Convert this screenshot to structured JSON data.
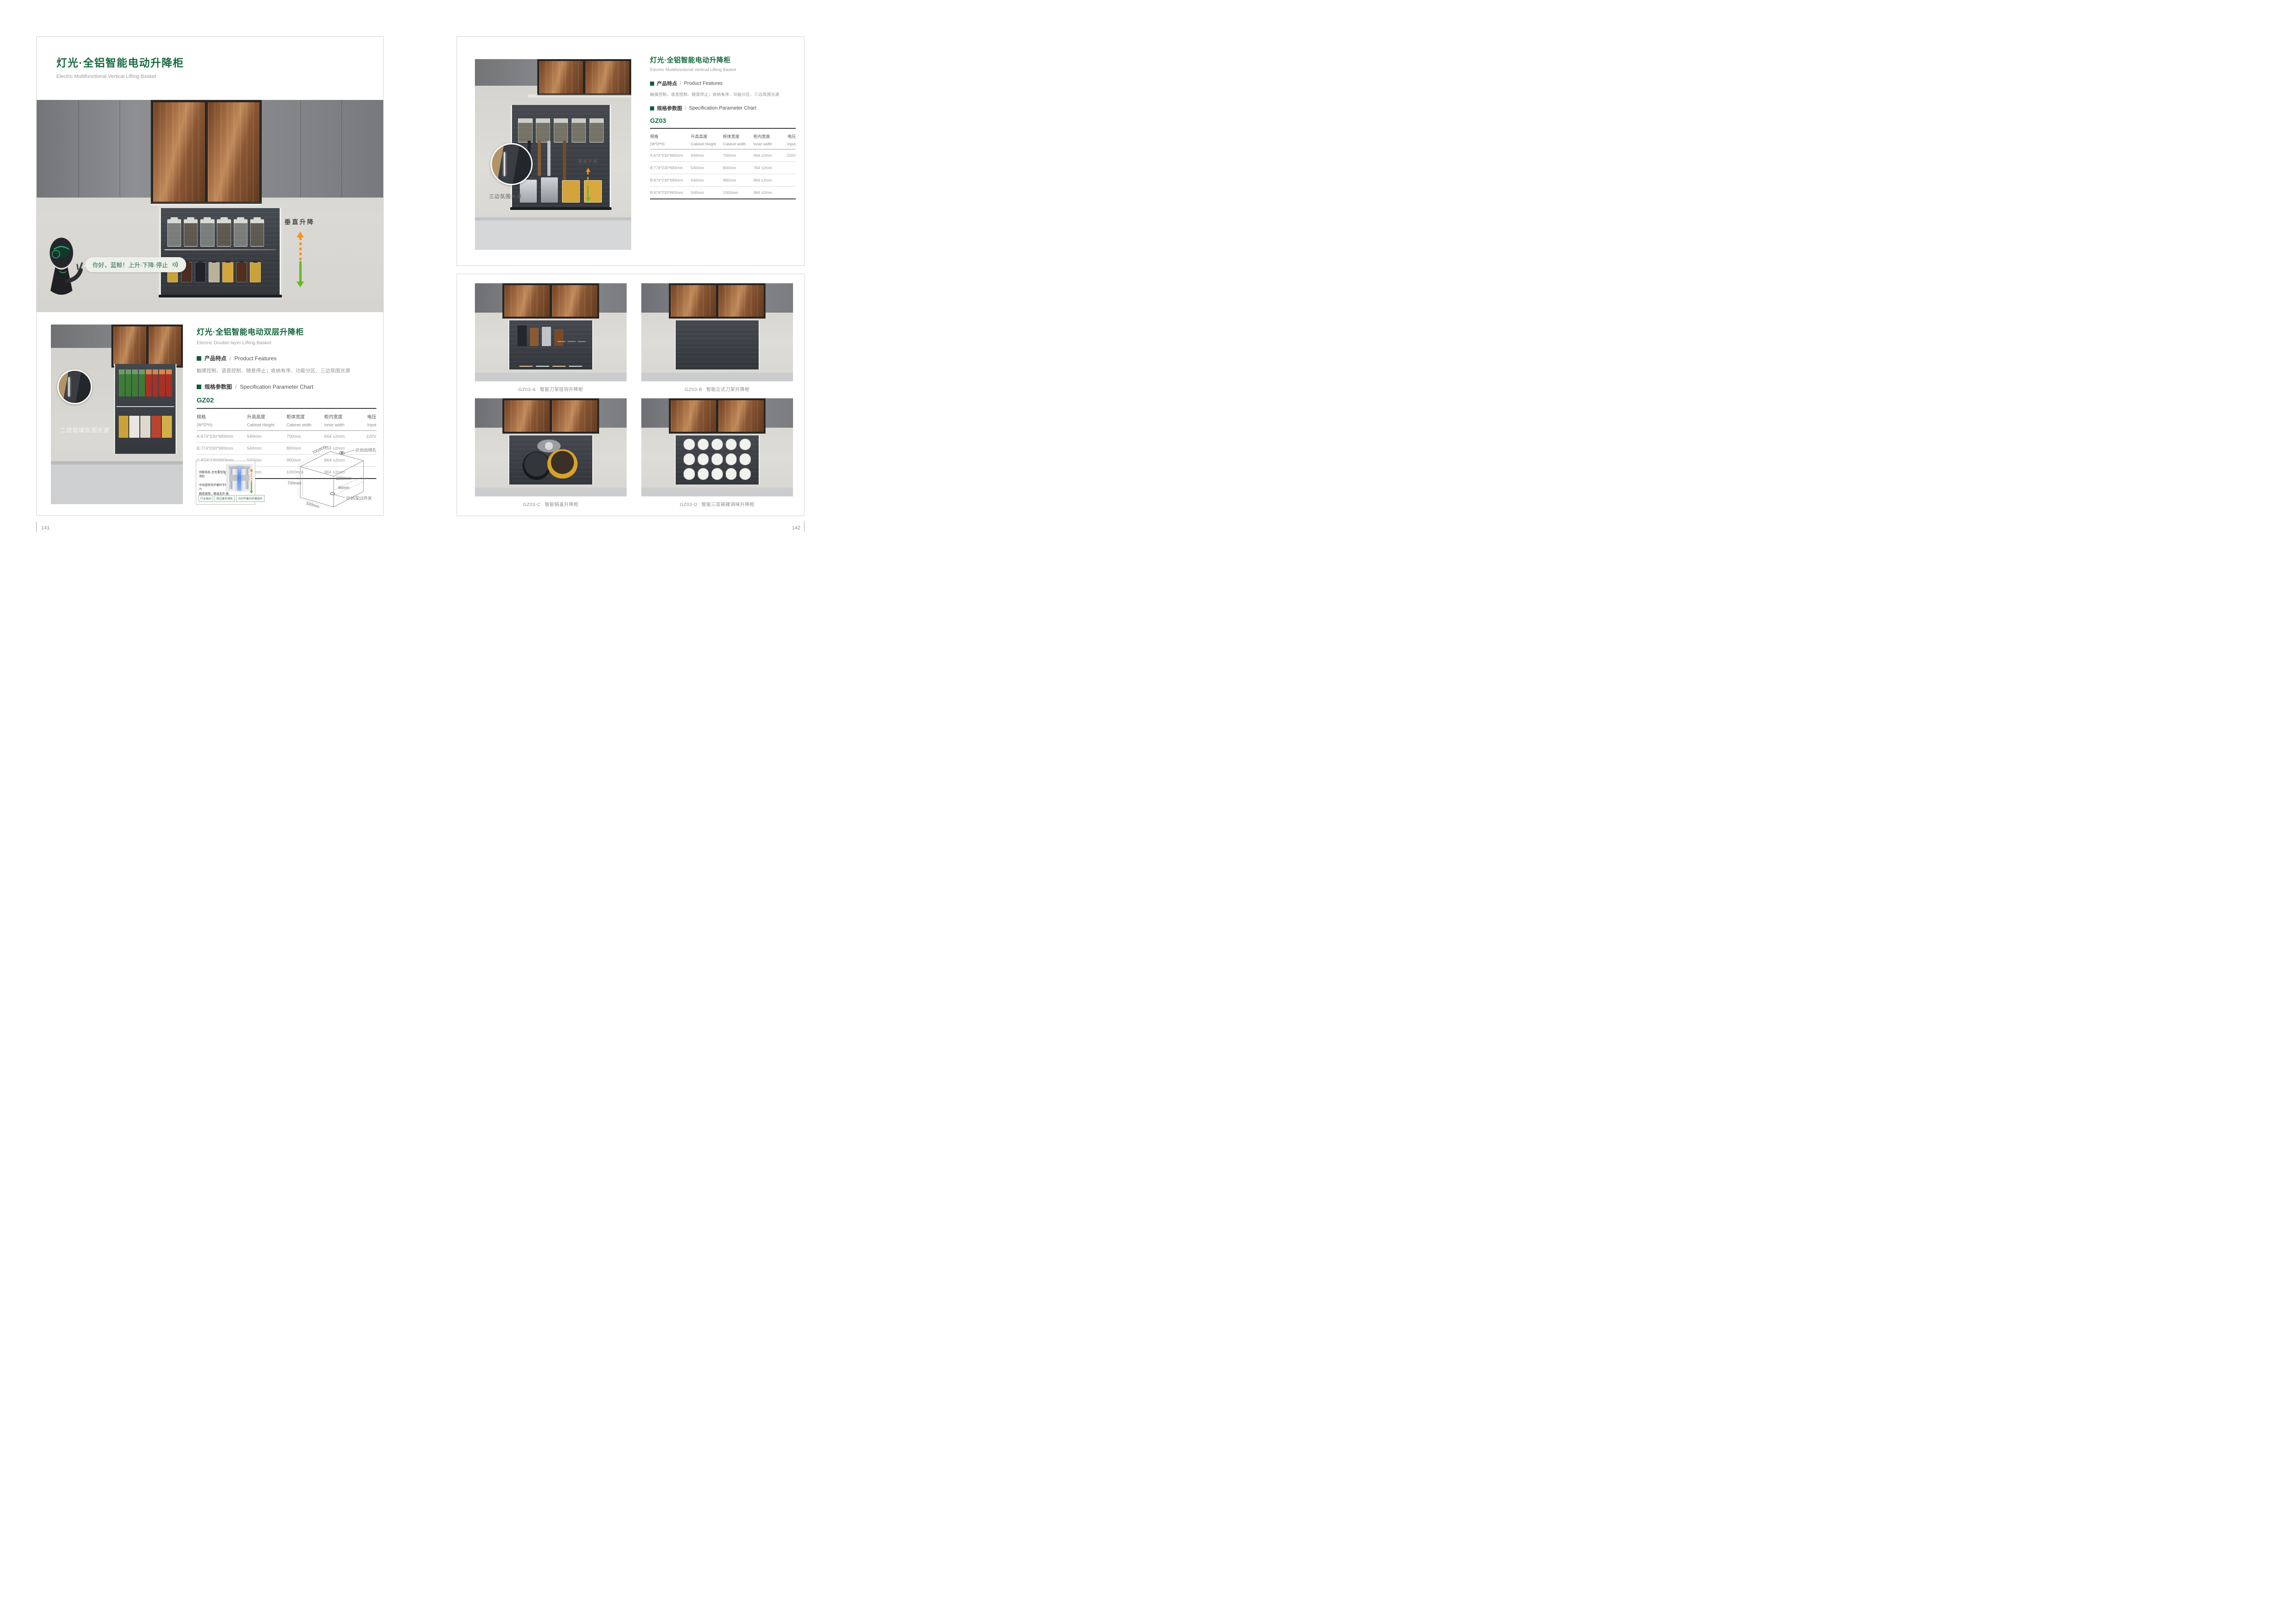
{
  "colors": {
    "accent_green": "#186a40",
    "bullet_green": "#0f5c38",
    "arrow_orange": "#f5941d",
    "arrow_green": "#6cb52d",
    "dim_red": "#e03a2f"
  },
  "sep": "/",
  "left": {
    "title": "灯光·全铝智能电动升降柜",
    "subtitle": "Electric Multifunctional Vertical Lifting Basket",
    "hero": {
      "speech": "你好，蓝鲸！上升·下降·停止",
      "lift_label": "垂直升降"
    },
    "lower": {
      "title": "灯光·全铝智能电动双层升降柜",
      "subtitle": "Electric Double-layer Lifting Basket",
      "features_zh": "产品特点",
      "features_en": "Product Features",
      "features_text": "触摸控制、语音控制、随意停止；收纳有序、功能分区、三边氛围光源",
      "spec_zh": "规格参数图",
      "spec_en": "Specification Parameter Chart",
      "model": "GZ02",
      "photo_label": "二层玻璃氛围光源"
    },
    "gz02_rows": [
      [
        "A:674*230*683mm",
        "540mm",
        "700mm",
        "664 ±2mm",
        "220V"
      ],
      [
        "B:774*230*683mm",
        "540mm",
        "800mm",
        "764 ±2mm",
        ""
      ],
      [
        "C:874*230*683mm",
        "540mm",
        "900mm",
        "864 ±2mm",
        ""
      ],
      [
        "D:974*230*683mm",
        "540mm",
        "1000mm",
        "964 ±2mm",
        ""
      ]
    ],
    "mech": {
      "callout1": "伺服电机·左右重型轴芯滑轨",
      "callout2a": "中间旋转同步螺杆平衡受力",
      "callout2b": "静密顺滑，静谧无声·载重量大",
      "badge1": "行业独创",
      "badge2": "两边重型滑轨",
      "badge3": "中间平衡同步螺旋杆"
    },
    "dim": {
      "top": "700/800/900/1000mm",
      "hole": "∅35出线孔",
      "height": "700mm",
      "inner": "220mm",
      "gap": "46mm",
      "switch": "∅35深15开关",
      "depth": "330mm"
    }
  },
  "right": {
    "title": "灯光·全铝智能电动升降柜",
    "subtitle": "Electric Multifunctional Vertical Lifting Basket",
    "features_zh": "产品特点",
    "features_en": "Product Features",
    "features_text": "触摸控制、语音控制、随意停止；收纳有序、功能分区、三边氛围光源",
    "spec_zh": "规格参数图",
    "spec_en": "Specification Parameter Chart",
    "model": "GZ03",
    "photo_label": "三边氛围光源",
    "lift_label": "垂直升降",
    "gz03_rows": [
      [
        "A:674*230*683mm",
        "540mm",
        "700mm",
        "664 ±2mm",
        "220V"
      ],
      [
        "B:774*230*683mm",
        "540mm",
        "800mm",
        "764 ±2mm",
        ""
      ],
      [
        "B:874*230*683mm",
        "540mm",
        "900mm",
        "864 ±2mm",
        ""
      ],
      [
        "B:974*230*683mm",
        "540mm",
        "1000mm",
        "964 ±2mm",
        ""
      ]
    ],
    "products": [
      {
        "code": "GZ03-A",
        "name": "智能刀架挂钩升降柜"
      },
      {
        "code": "GZ03-B",
        "name": "智能立式刀架升降柜"
      },
      {
        "code": "GZ03-C",
        "name": "智能锅盖升降柜"
      },
      {
        "code": "GZ03-D",
        "name": "智能三层碗碟调味升降柜"
      }
    ]
  },
  "table_headers": {
    "c1_zh": "规格",
    "c1_en": "(W*D*H)",
    "c2_zh": "升高高度",
    "c2_en": "Cabinet Height",
    "c3_zh": "柜体宽度",
    "c3_en": "Cabinet width",
    "c4_zh": "柜内宽度",
    "c4_en": "Inner width",
    "c5_zh": "电压",
    "c5_en": "Input"
  },
  "footer": {
    "page_left": "141",
    "page_right": "142"
  }
}
